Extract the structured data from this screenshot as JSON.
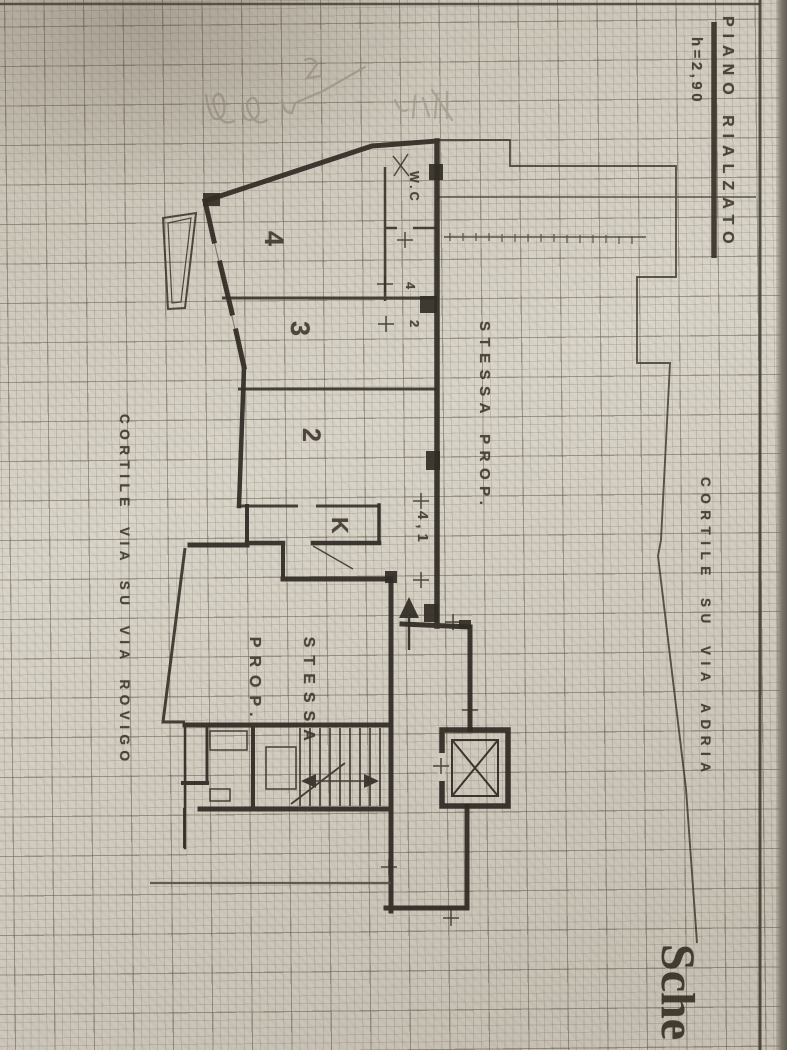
{
  "sheet": {
    "floor_title": "PIANO RIALZATO",
    "floor_height": "h=2,90",
    "corner_caption": "Sche"
  },
  "annotations": {
    "courtyard_right": "CORTILE SU VIA ADRIA",
    "courtyard_left": "CORTILE VIA SU VIA ROVIGO",
    "same_property_center": "STESSA PROP.",
    "same_property_lower": {
      "line1": "STESSA",
      "line2": "PROP."
    }
  },
  "rooms": {
    "room4": "4",
    "room3": "3",
    "room2": "2",
    "kitchen": "K",
    "wc": "W.C"
  },
  "dimensions": {
    "entry_width": "4,1",
    "upper_marks": [
      "4",
      "2"
    ]
  },
  "colors": {
    "ink": "#2b251e",
    "paper": "#d8d3c7",
    "pencil": "#a39d8f"
  }
}
